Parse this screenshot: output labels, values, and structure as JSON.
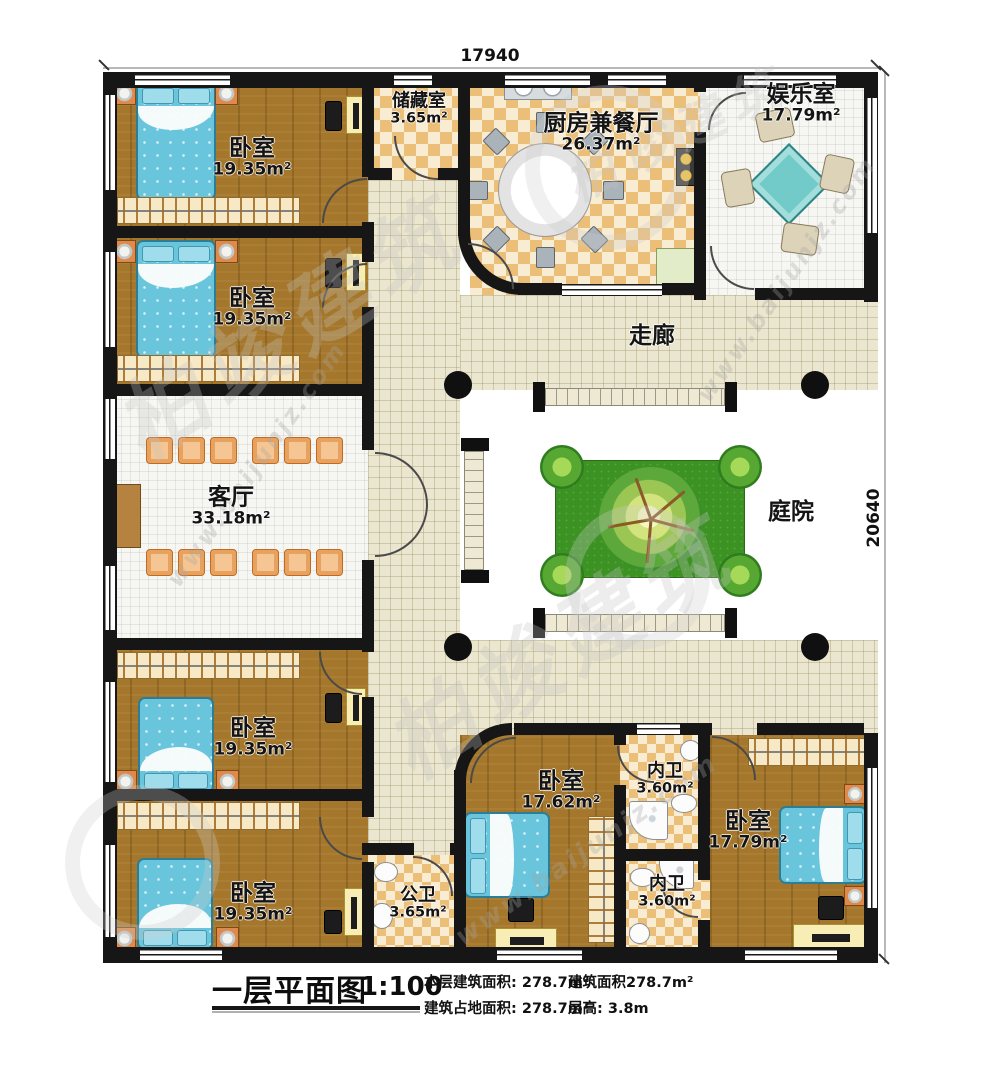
{
  "plan": {
    "title": "一层平面图",
    "scale": "1:100",
    "stats": [
      {
        "label": "本层建筑面积:",
        "value": "278.7m²"
      },
      {
        "label": "建筑占地面积:",
        "value": "278.7m²"
      },
      {
        "label": "建筑面积",
        "value": "278.7m²"
      },
      {
        "label": "层高:",
        "value": "3.8m"
      }
    ]
  },
  "dimensions": {
    "width_top": "17940",
    "height_right": "20640"
  },
  "rooms": {
    "bedroom_nw": {
      "name": "卧室",
      "area": "19.35m²"
    },
    "bedroom_w": {
      "name": "卧室",
      "area": "19.35m²"
    },
    "storage": {
      "name": "储藏室",
      "area": "3.65m²"
    },
    "kitchen_dining": {
      "name": "厨房兼餐厅",
      "area": "26.37m²"
    },
    "entertainment": {
      "name": "娱乐室",
      "area": "17.79m²"
    },
    "corridor": {
      "name": "走廊",
      "area": ""
    },
    "living": {
      "name": "客厅",
      "area": "33.18m²"
    },
    "courtyard": {
      "name": "庭院",
      "area": ""
    },
    "bedroom_sw1": {
      "name": "卧室",
      "area": "19.35m²"
    },
    "bedroom_sw2": {
      "name": "卧室",
      "area": "19.35m²"
    },
    "public_bath": {
      "name": "公卫",
      "area": "3.65m²"
    },
    "bedroom_s": {
      "name": "卧室",
      "area": "17.62m²"
    },
    "ensuite_bath_n": {
      "name": "内卫",
      "area": "3.60m²"
    },
    "ensuite_bath_s": {
      "name": "内卫",
      "area": "3.60m²"
    },
    "bedroom_se": {
      "name": "卧室",
      "area": "17.79m²"
    }
  },
  "watermark": {
    "brand": "柏竣建筑",
    "site": "www.baijunjz.com"
  }
}
